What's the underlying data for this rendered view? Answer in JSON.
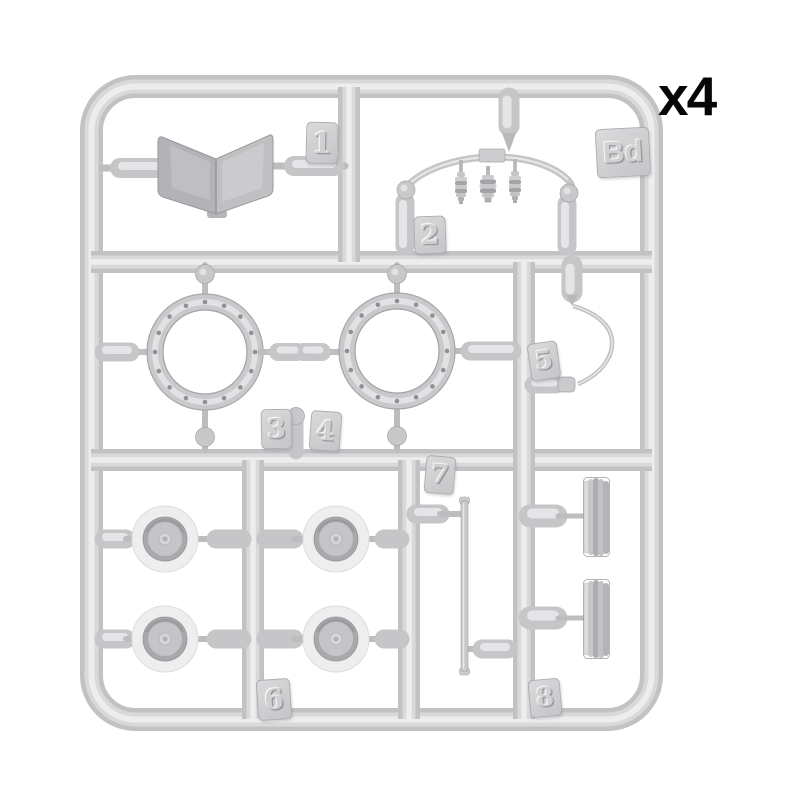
{
  "labels": {
    "quantity": "x4",
    "sprue_id": "Bd",
    "part_1": "1",
    "part_2": "2",
    "part_3": "3",
    "part_4": "4",
    "part_5": "5",
    "part_6": "6",
    "part_7": "7",
    "part_8": "8"
  },
  "palette": {
    "background": "#ffffff",
    "plastic_base": "#cdcdd0",
    "plastic_highlight": "#ececee",
    "plastic_shadow": "#a6a6aa",
    "quantity_text": "#060606"
  }
}
